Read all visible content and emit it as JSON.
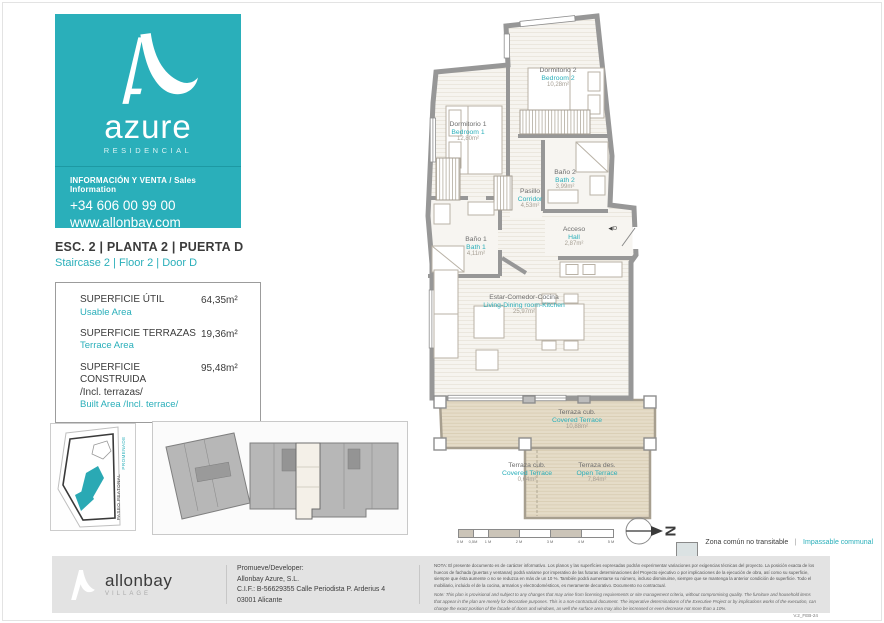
{
  "brand": {
    "name": "azure",
    "tagline": "RESIDENCIAL",
    "info_label": "INFORMACIÓN Y VENTA / Sales Information",
    "phone": "+34 606 00 99 00",
    "web": "www.allonbay.com",
    "teal": "#2aafba"
  },
  "unit": {
    "title": "ESC. 2 | PLANTA 2 | PUERTA D",
    "subtitle": "Staircase 2 | Floor 2 | Door D"
  },
  "areas": {
    "usable": {
      "es": "SUPERFICIE ÚTIL",
      "en": "Usable Area",
      "value": "64,35m²"
    },
    "terrace": {
      "es": "SUPERFICIE TERRAZAS",
      "en": "Terrace Area",
      "value": "19,36m²"
    },
    "built": {
      "es": "SUPERFICIE CONSTRUIDA",
      "es2": "/Incl. terrazas/",
      "en": "Built Area /Incl. terrace/",
      "value": "95,48m²"
    }
  },
  "site_map": {
    "street": "PASEO PEATONAL",
    "street_en": "PROMENADE"
  },
  "plan": {
    "door": "◀D",
    "rooms": {
      "bedroom2": {
        "es": "Dormitorio 2",
        "en": "Bedroom 2",
        "area": "10,28m²"
      },
      "bedroom1": {
        "es": "Dormitorio 1",
        "en": "Bedroom 1",
        "area": "12,80m²"
      },
      "bath2": {
        "es": "Baño 2",
        "en": "Bath 2",
        "area": "3,99m²"
      },
      "corridor": {
        "es": "Pasillo",
        "en": "Corridor",
        "area": "4,53m²"
      },
      "hall": {
        "es": "Acceso",
        "en": "Hall",
        "area": "2,87m²"
      },
      "bath1": {
        "es": "Baño 1",
        "en": "Bath 1",
        "area": "4,11m²"
      },
      "living": {
        "es": "Estar-Comedor-Cocina",
        "en": "Living-Dining room-Kitchen",
        "area": "25,97m²"
      },
      "terrace_covered": {
        "es": "Terraza cub.",
        "en": "Covered Terrace",
        "area": "10,88m²"
      },
      "terrace_covered_small": {
        "es": "Terraza cub.",
        "en": "Covered Terrace",
        "area": "0,64m²"
      },
      "terrace_open": {
        "es": "Terraza des.",
        "en": "Open Terrace",
        "area": "7,84m²"
      }
    }
  },
  "scale_bar": {
    "labels": [
      "0 M",
      "0,5M",
      "1 M",
      "2 M",
      "3 M",
      "4 M",
      "5 M"
    ]
  },
  "legend": {
    "es": "Zona común no transitable",
    "sep": "|",
    "en": "Impassable communal area"
  },
  "footer": {
    "logo": "allonbay",
    "logo_sub": "VILLAGE",
    "dev_label": "Promueve/Developer:",
    "dev_name": "Allonbay Azure, S.L.",
    "dev_cif": "C.I.F.: B-56629355 Calle Periodista P. Arderius 4",
    "dev_city": "03001 Alicante",
    "note_es": "NOTA: El presente documento es de carácter informativo. Los planos y las superficies expresadas podrán experimentar variaciones por exigencias técnicas del proyecto. La posición exacta de los huecos de fachada (puertas y ventanas) podrá variarse por imperativo de las futuras determinaciones del Proyecto ejecutivo o por implicaciones de la ejecución de obra, así como su superficie, siempre que ésta aumente o no se reduzca en más de un 10 %. También podrá aumentarse su número, incluso disminuirse, siempre que se mantenga la anterior condición de superficie. Todo el mobiliario, incluido el de la cocina, armarios y electrodomésticos, es meramente decorativo. Documento no contractual.",
    "note_en": "Note: This plan is provisional and subject to any changes that may arise from licensing requirements or site management criteria, without compromising quality. The furniture and household items that appear in the plan are merely for decorative purposes. This is a non-contractual document. The imperative determinations of the Executive Project or by implications works of the execution, can change the exact position of the facade of doors and windows, as well the surface area may also be increased or even decrease not more than a 10%.",
    "version": "V.2_FEB-24"
  }
}
